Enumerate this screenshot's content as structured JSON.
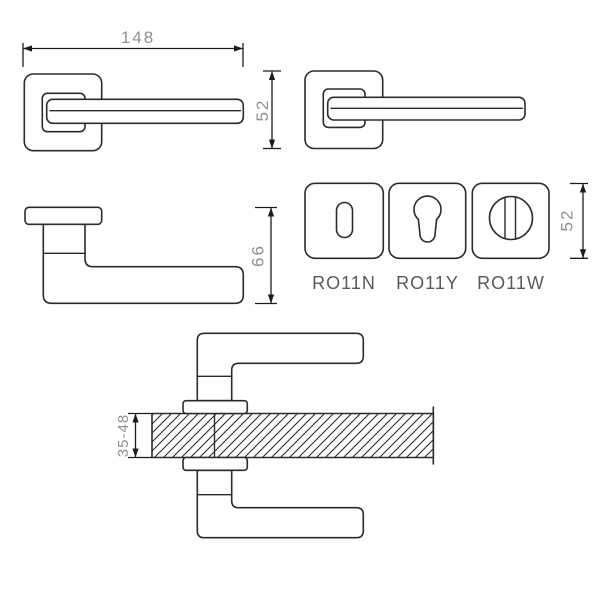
{
  "theme": {
    "bg_color": "#ffffff",
    "line_color": "#2b2b2b",
    "dim_color": "#1c1c1c",
    "dim_text_color": "#8f8f8f",
    "label_text_color": "#595959"
  },
  "views": {
    "top_view": {
      "dimension_width": "148"
    },
    "front_view": {
      "dimension_height": "52"
    },
    "side_view": {
      "dimension_height": "66"
    },
    "rosettes": {
      "dimension_height": "52",
      "items": [
        {
          "label": "RO11N",
          "hole": "keyhole"
        },
        {
          "label": "RO11Y",
          "hole": "euro-cylinder"
        },
        {
          "label": "RO11W",
          "hole": "wc-turn"
        }
      ]
    },
    "section_view": {
      "dimension_door_thickness": "35-48"
    }
  }
}
